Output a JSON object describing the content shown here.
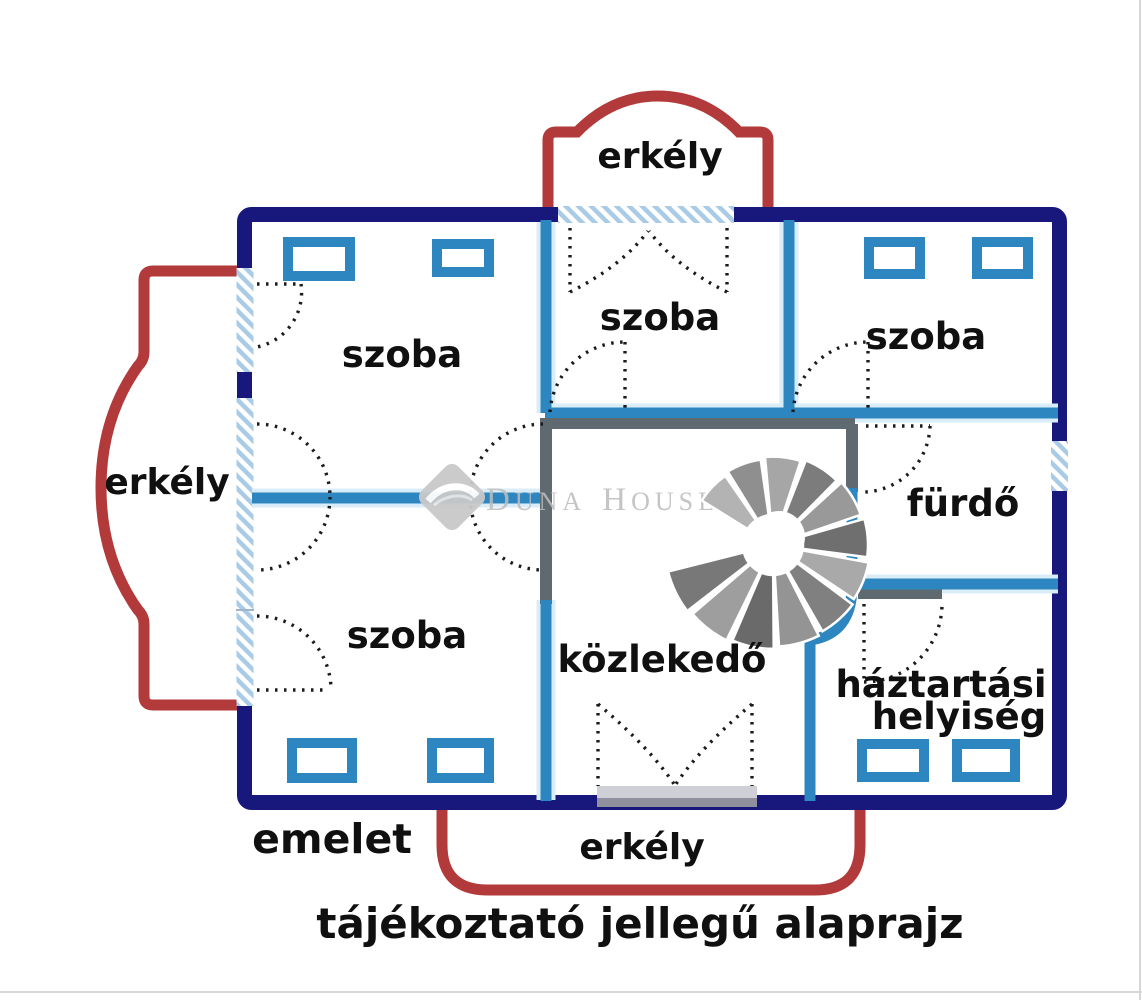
{
  "caption": "tájékoztató jellegű alaprajz",
  "floor_label": "emelet",
  "rooms": [
    {
      "id": "szoba-top-left",
      "label": "szoba"
    },
    {
      "id": "szoba-top-middle",
      "label": "szoba"
    },
    {
      "id": "szoba-top-right",
      "label": "szoba"
    },
    {
      "id": "szoba-bottom-left",
      "label": "szoba"
    },
    {
      "id": "furdo",
      "label": "fürdő"
    },
    {
      "id": "kozlekedo",
      "label": "közlekedő"
    },
    {
      "id": "haztartasi-helyiseg",
      "label_line1": "háztartási",
      "label_line2": "helyiség"
    }
  ],
  "balconies": {
    "top": "erkély",
    "left": "erkély",
    "bottom": "erkély"
  },
  "watermark": {
    "d": "D",
    "una": "UNA ",
    "h": "H",
    "ouse": "OUSE",
    "reg": "®"
  },
  "colors": {
    "outer_wall": "#17177c",
    "interior_wall": "#2e86c1",
    "gray_wall": "#5f6a70",
    "hatch": "#a9cbe6",
    "balcony": "#b23a3a",
    "text": "#101010",
    "watermark": "#bcbcbc"
  }
}
